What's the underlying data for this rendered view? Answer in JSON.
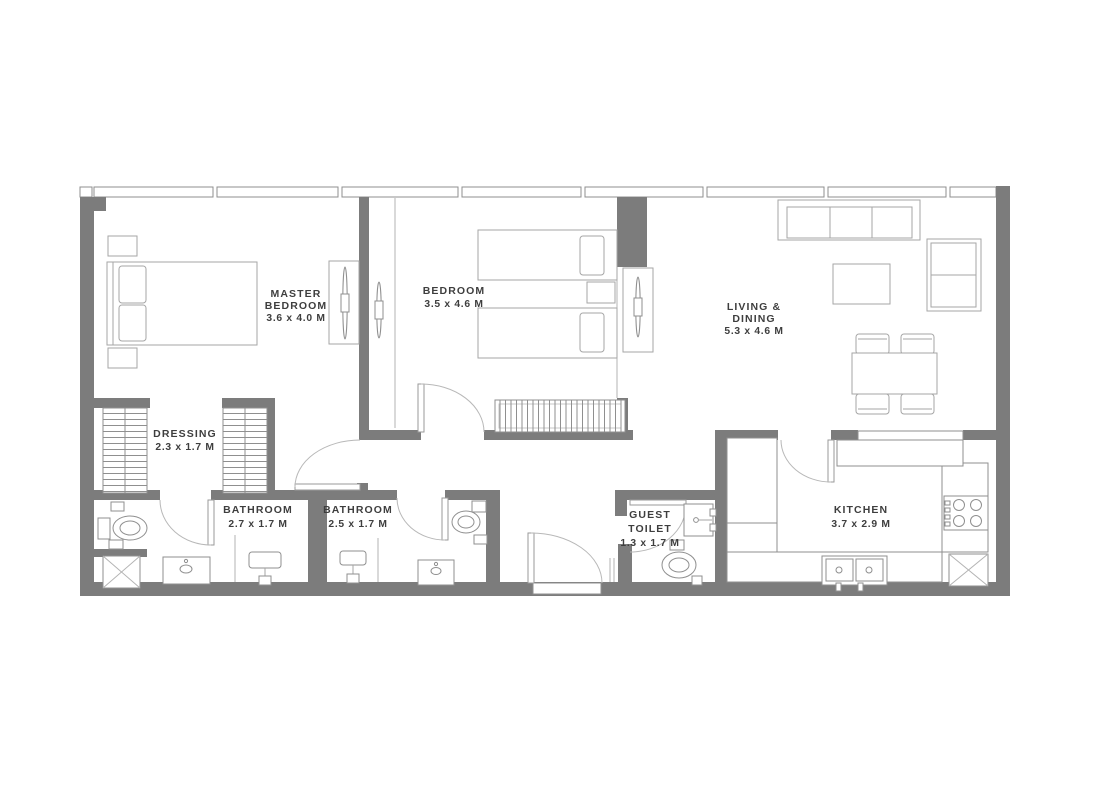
{
  "plan": {
    "type": "apartment-floor-plan",
    "units": "M"
  },
  "rooms": {
    "master_bedroom": {
      "name_line1": "MASTER",
      "name_line2": "BEDROOM",
      "dims": "3.6 x 4.0 M"
    },
    "bedroom": {
      "name": "BEDROOM",
      "dims": "3.5 x 4.6 M"
    },
    "living_dining": {
      "name_line1": "LIVING &",
      "name_line2": "DINING",
      "dims": "5.3 x 4.6 M"
    },
    "dressing": {
      "name": "DRESSING",
      "dims": "2.3 x 1.7 M"
    },
    "bathroom_master": {
      "name": "BATHROOM",
      "dims": "2.7 x 1.7 M"
    },
    "bathroom_shared": {
      "name": "BATHROOM",
      "dims": "2.5 x 1.7 M"
    },
    "guest_toilet": {
      "name_line1": "GUEST",
      "name_line2": "TOILET",
      "dims": "1.3 x 1.7 M"
    },
    "kitchen": {
      "name": "KITCHEN",
      "dims": "3.7 x 2.9 M"
    }
  },
  "colors": {
    "wall": "#7c7c7c",
    "furniture_line": "#a6a6a6",
    "label_text": "#3e3e3e",
    "background": "#ffffff"
  }
}
